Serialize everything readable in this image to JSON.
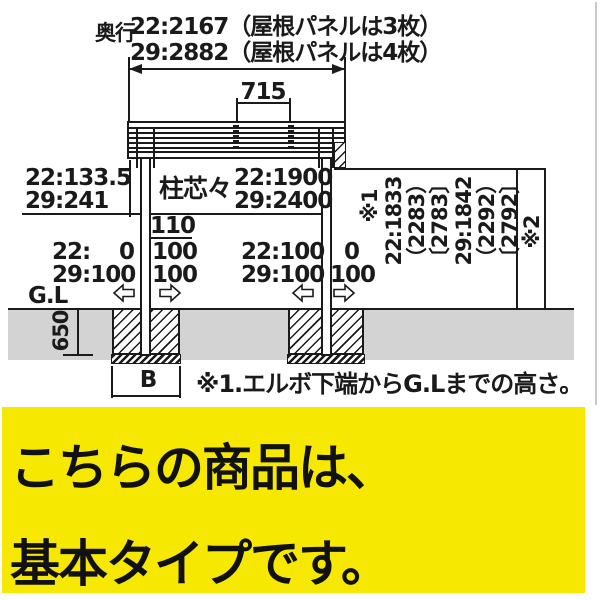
{
  "colors": {
    "ink": "#1a1a1a",
    "ground": "#d3d3d3",
    "banner_bg": "#F6E800"
  },
  "dims": {
    "depth_label": "奥行",
    "depth_22": "22:2167（屋根パネルは3枚）",
    "depth_29": "29:2882（屋根パネルは4枚）",
    "roof_span": "715",
    "eave_offset_22": "22:133.5",
    "eave_offset_29": "29:241",
    "pitch_label": "柱芯々",
    "pitch_22": "22:1900",
    "pitch_29": "29:2400",
    "post_width": "110",
    "footing_depth": "650",
    "footing_width": "B",
    "gl": "G.L"
  },
  "adjust": {
    "left_outer_label": "22:",
    "left_outer_value": "0",
    "left_outer_29": "29:100",
    "left_inner_r1": "100",
    "left_inner_r2": "100",
    "right_inner_22": "22:100",
    "right_inner_29": "29:100",
    "right_outer_r1": "0",
    "right_outer_r2": "100"
  },
  "heights": {
    "ref1": "※1",
    "ref2": "※2",
    "h22": [
      "22:1833",
      "（2283）",
      "〔2783〕"
    ],
    "h29": [
      "29:1842",
      "（2292）",
      "〔2792〕"
    ]
  },
  "note": "※1.エルボ下端からG.Lまでの高さ。",
  "banner": {
    "line1": "こちらの商品は、",
    "line2": "基本タイプです。"
  }
}
